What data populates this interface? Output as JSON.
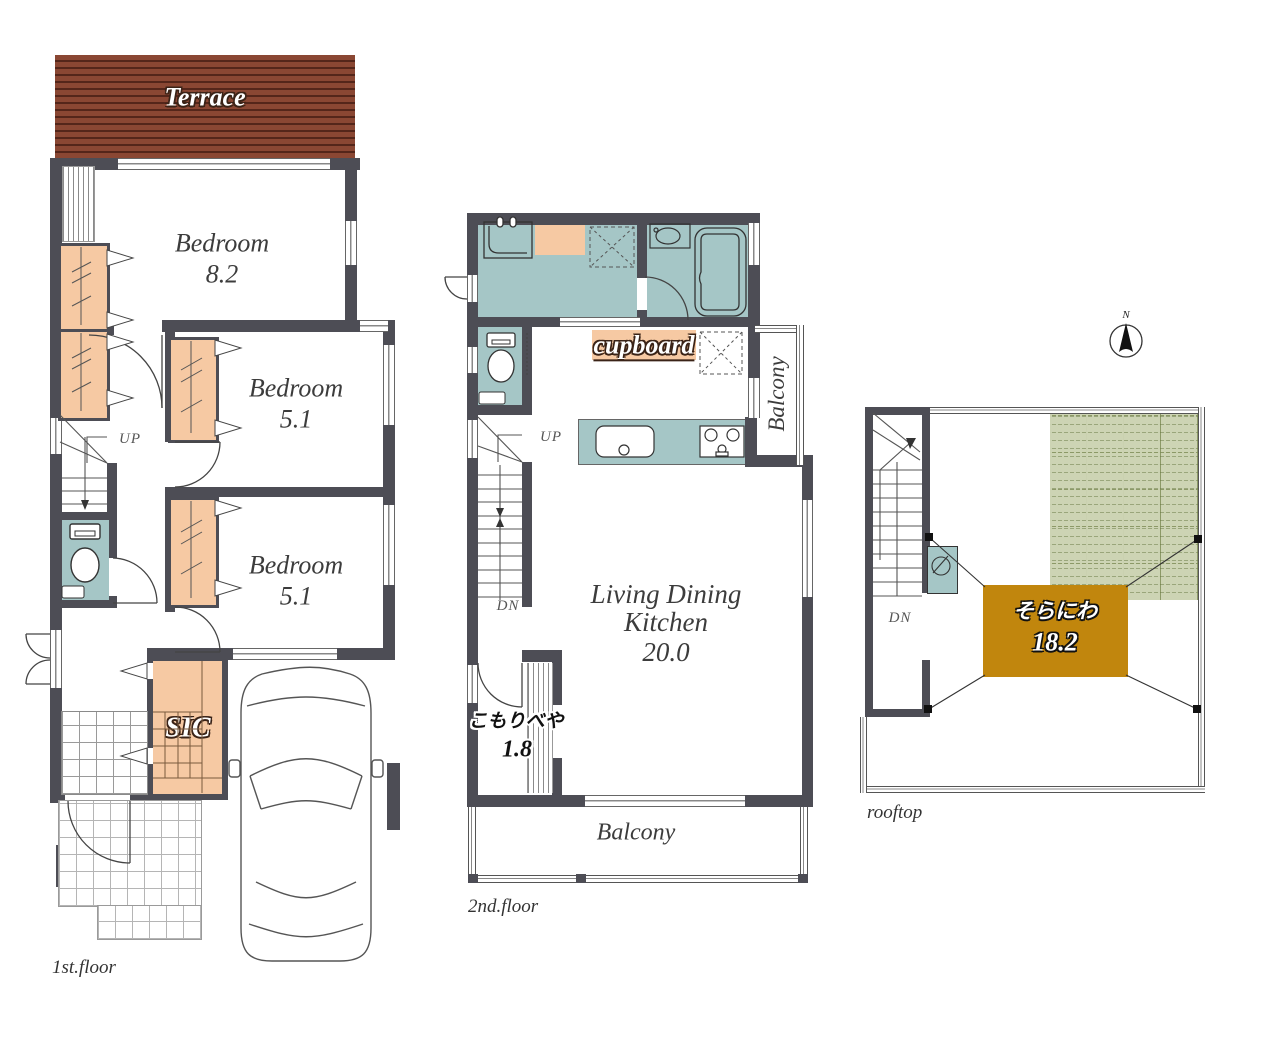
{
  "floor1": {
    "name_label": "1st.floor",
    "terrace_label": "Terrace",
    "bedroom1": {
      "name": "Bedroom",
      "area": "8.2"
    },
    "bedroom2": {
      "name": "Bedroom",
      "area": "5.1"
    },
    "bedroom3": {
      "name": "Bedroom",
      "area": "5.1"
    },
    "sic_label": "SIC",
    "up_label": "UP"
  },
  "floor2": {
    "name_label": "2nd.floor",
    "cupboard_label": "cupboard",
    "balcony_right_label": "Balcony",
    "balcony_bottom_label": "Balcony",
    "ldk": {
      "line1": "Living Dining",
      "line2": "Kitchen",
      "area": "20.0"
    },
    "komoribeya": {
      "name": "こもりべや",
      "area": "1.8"
    },
    "up_label": "UP",
    "dn_label": "DN"
  },
  "rooftop": {
    "name_label": "rooftop",
    "soraniwa": {
      "name": "そらにわ",
      "area": "18.2"
    },
    "dn_label": "DN",
    "north_label": "N"
  },
  "colors": {
    "wall": "#4d4d55",
    "wet_area": "#a5c6c6",
    "closet": "#f6c9a3",
    "terrace": "#8a4733",
    "soraniwa": "#c1860d",
    "grass": "#cdd4b4"
  }
}
